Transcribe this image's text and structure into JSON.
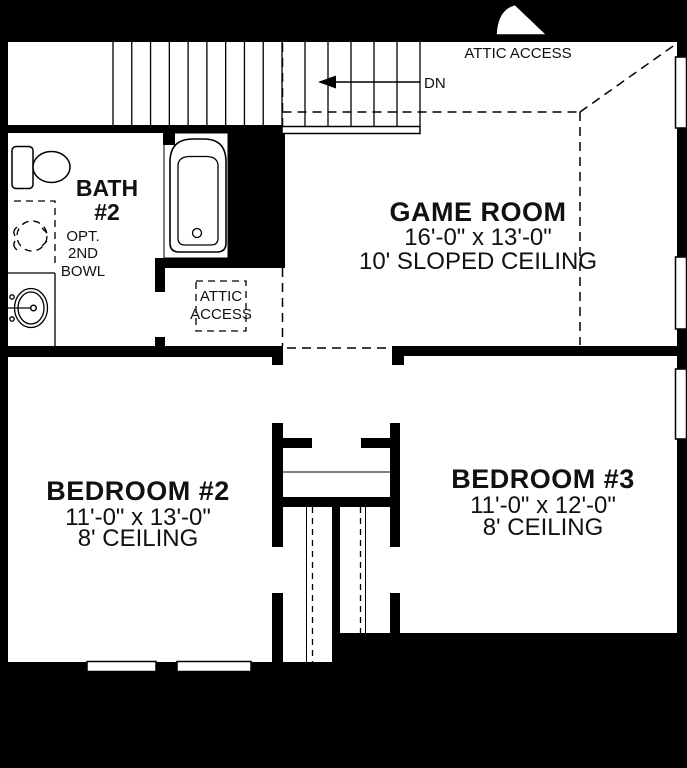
{
  "title": "Second Floor Plan",
  "colors": {
    "wall": "#000000",
    "floor": "#ffffff"
  },
  "labels": {
    "attic_access_top": "ATTIC ACCESS",
    "down": "DN",
    "attic_access_box": [
      "ATTIC",
      "ACCESS"
    ],
    "opt_bowl": [
      "OPT.",
      "2ND",
      "BOWL"
    ]
  },
  "rooms": {
    "game_room": {
      "name": "GAME ROOM",
      "dimensions": "16'-0\" x 13'-0\"",
      "ceiling": "10' SLOPED CEILING"
    },
    "bath2": {
      "name": "BATH",
      "number": "#2"
    },
    "bedroom2": {
      "name": "BEDROOM #2",
      "dimensions": "11'-0\" x 13'-0\"",
      "ceiling": "8' CEILING"
    },
    "bedroom3": {
      "name": "BEDROOM #3",
      "dimensions": "11'-0\" x 12'-0\"",
      "ceiling": "8' CEILING"
    }
  }
}
